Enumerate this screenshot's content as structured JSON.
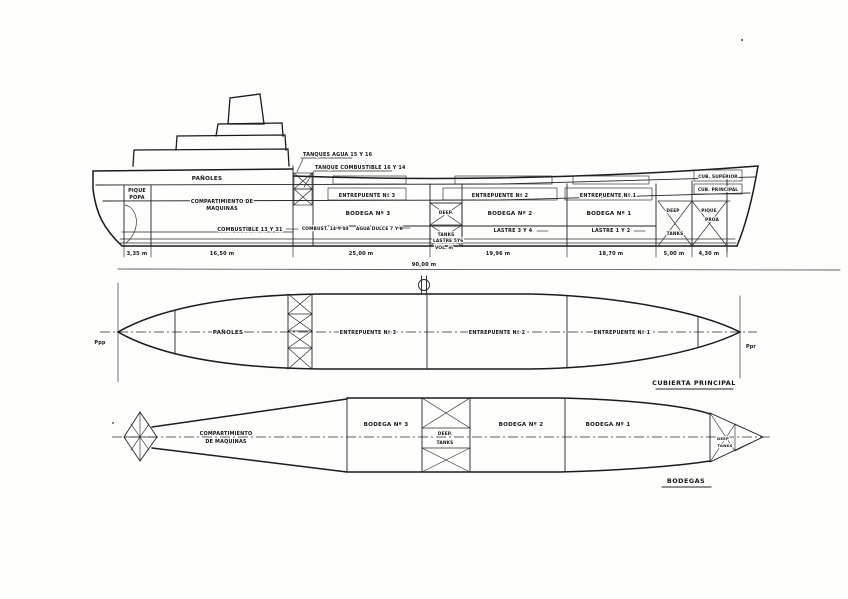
{
  "drawing": {
    "type": "ship-general-arrangement",
    "ink_color": "#1b1b1b",
    "paper_color": "#fdfdfc"
  },
  "profile_view": {
    "leader_labels": {
      "tanques_agua": "TANQUES AGUA 15 Y 16",
      "tanque_combustible": "TANQUE COMBUSTIBLE 16 Y 14"
    },
    "compartments": {
      "panoles": "PAÑOLES",
      "pique_popa_line1": "PIQUE",
      "pique_popa_line2": "POPA",
      "maquinas_line1": "COMPARTIMIENTO DE",
      "maquinas_line2": "MAQUINAS",
      "combustible": "COMBUSTIBLE 13 Y 31",
      "combust": "COMBUST. 14 Y 13",
      "agua_dulce": "AGUA DULCE 7 Y 8",
      "entrepuente3": "ENTREPUENTE Nº 3",
      "bodega3": "BODEGA Nº 3",
      "deep_mid_line1": "DEEP.",
      "deep_mid_line2": "TANKS",
      "lastre56_line1": "LASTRE 5Y6",
      "lastre56_line2": "VOL. m",
      "entrepuente2": "ENTREPUENTE Nº 2",
      "bodega2": "BODEGA Nº 2",
      "lastre34": "LASTRE 3 Y 4",
      "entrepuente1": "ENTREPUENTE Nº 1",
      "bodega1": "BODEGA Nº 1",
      "lastre12": "LASTRE 1 Y 2",
      "cub_superior": "CUB. SUPERIOR",
      "cub_principal": "CUB. PRINCIPAL",
      "deep_bow_line1": "DEEP",
      "deep_bow_line2": "TANKS",
      "pique_proa_line1": "PIQUE",
      "pique_proa_line2": "PROA"
    },
    "dimensions": [
      "3,35 m",
      "16,50 m",
      "25,00 m",
      "19,96 m",
      "18,70 m",
      "5,00 m",
      "4,30 m"
    ],
    "total_length": "90,00 m"
  },
  "main_deck_view": {
    "title": "CUBIERTA PRINCIPAL",
    "perpendicular_aft": "Ppp",
    "perpendicular_fwd": "Ppr",
    "labels": {
      "panoles": "PAÑOLES",
      "entrepuente3": "ENTREPUENTE Nº 3",
      "entrepuente2": "ENTREPUENTE Nº 2",
      "entrepuente1": "ENTREPUENTE Nº 1"
    }
  },
  "holds_view": {
    "title": "BODEGAS",
    "labels": {
      "maquinas_line1": "COMPARTIMIENTO",
      "maquinas_line2": "DE MAQUINAS",
      "bodega3": "BODEGA Nº 3",
      "bodega2": "BODEGA Nº 2",
      "bodega1": "BODEGA Nº 1",
      "deep_mid_line1": "DEEP.",
      "deep_mid_line2": "TANKS",
      "deep_bow_line1": "DEEP",
      "deep_bow_line2": "TANKS"
    }
  }
}
